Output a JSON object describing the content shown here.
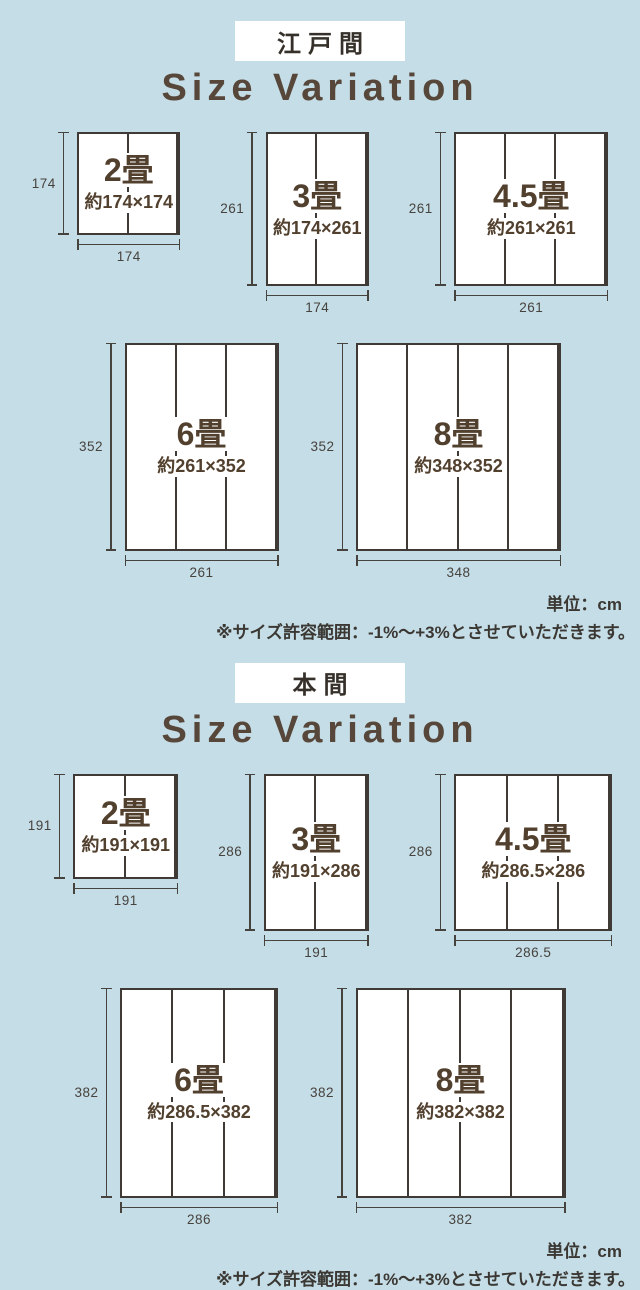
{
  "colors": {
    "background": "#c5dde6",
    "panel_fill": "#ffffff",
    "line": "#3f3a35",
    "dim": "#46423e",
    "brown": "#52402e",
    "title": "#57473a",
    "tag_text": "#36302a",
    "note": "#3b3834"
  },
  "unit": "cm",
  "sections": [
    {
      "tag": "江戸間",
      "title": "Size Variation",
      "unit_note": "単位：cm",
      "tolerance_note": "※サイズ許容範囲：-1%～+3%とさせていただきます。",
      "rows": [
        [
          {
            "label": "2畳",
            "dims_text": "約174×174",
            "width_cm": 174,
            "height_cm": 174,
            "panels": 2,
            "height_label": "174",
            "width_label": "174"
          },
          {
            "label": "3畳",
            "dims_text": "約174×261",
            "width_cm": 174,
            "height_cm": 261,
            "panels": 2,
            "height_label": "261",
            "width_label": "174"
          },
          {
            "label": "4.5畳",
            "dims_text": "約261×261",
            "width_cm": 261,
            "height_cm": 261,
            "panels": 3,
            "height_label": "261",
            "width_label": "261"
          }
        ],
        [
          {
            "label": "6畳",
            "dims_text": "約261×352",
            "width_cm": 261,
            "height_cm": 352,
            "panels": 3,
            "height_label": "352",
            "width_label": "261"
          },
          {
            "label": "8畳",
            "dims_text": "約348×352",
            "width_cm": 348,
            "height_cm": 352,
            "panels": 4,
            "height_label": "352",
            "width_label": "348"
          }
        ]
      ]
    },
    {
      "tag": "本間",
      "title": "Size Variation",
      "unit_note": "単位：cm",
      "tolerance_note": "※サイズ許容範囲：-1%～+3%とさせていただきます。",
      "rows": [
        [
          {
            "label": "2畳",
            "dims_text": "約191×191",
            "width_cm": 191,
            "height_cm": 191,
            "panels": 2,
            "height_label": "191",
            "width_label": "191"
          },
          {
            "label": "3畳",
            "dims_text": "約191×286",
            "width_cm": 191,
            "height_cm": 286,
            "panels": 2,
            "height_label": "286",
            "width_label": "191"
          },
          {
            "label": "4.5畳",
            "dims_text": "約286.5×286",
            "width_cm": 286.5,
            "height_cm": 286,
            "panels": 3,
            "height_label": "286",
            "width_label": "286.5"
          }
        ],
        [
          {
            "label": "6畳",
            "dims_text": "約286.5×382",
            "width_cm": 286.5,
            "height_cm": 382,
            "panels": 3,
            "height_label": "382",
            "width_label": "286"
          },
          {
            "label": "8畳",
            "dims_text": "約382×382",
            "width_cm": 382,
            "height_cm": 382,
            "panels": 4,
            "height_label": "382",
            "width_label": "382"
          }
        ]
      ]
    }
  ]
}
